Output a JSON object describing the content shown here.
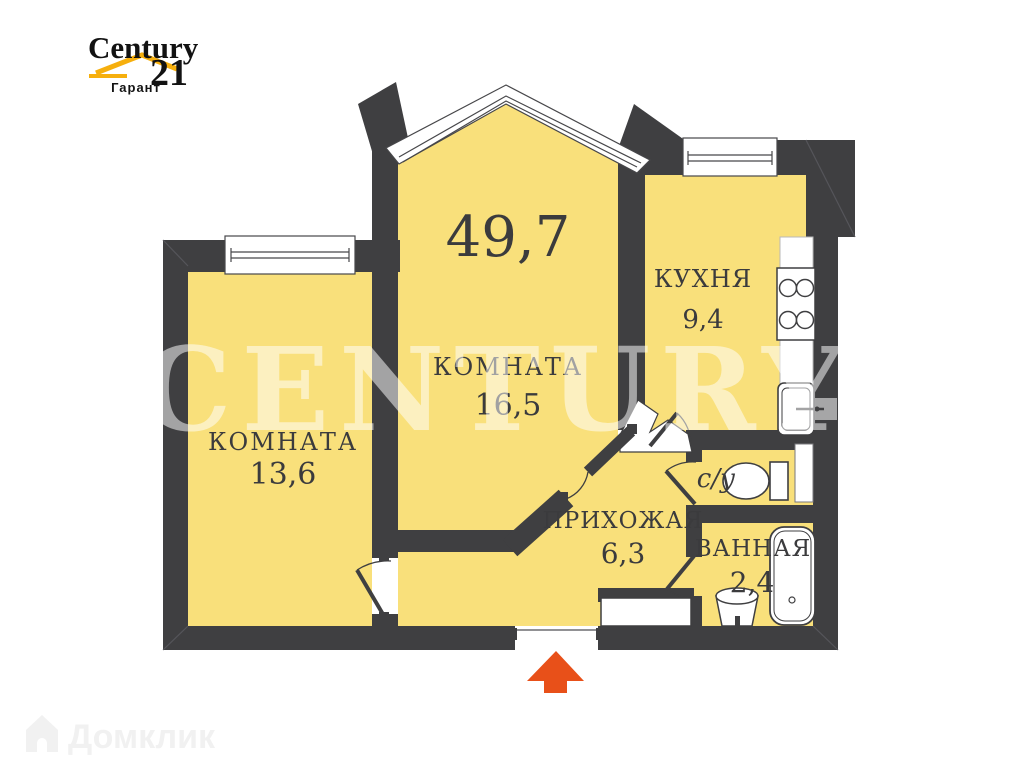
{
  "branding": {
    "agency_logo": {
      "name": "Century",
      "number": "21",
      "subtitle": "Гарант"
    },
    "watermark_text": "CENTURY 21",
    "portal_watermark": "Домклик"
  },
  "plan": {
    "total_area": "49,7",
    "rooms": [
      {
        "id": "room-left",
        "label": "КОМНАТА",
        "area": "13,6"
      },
      {
        "id": "room-middle",
        "label": "КОМНАТА",
        "area": "16,5"
      },
      {
        "id": "kitchen",
        "label": "КУХНЯ",
        "area": "9,4"
      },
      {
        "id": "wc",
        "label": "с/у",
        "area": ""
      },
      {
        "id": "hallway",
        "label": "ПРИХОЖАЯ",
        "area": "6,3"
      },
      {
        "id": "bathroom",
        "label": "ВАННАЯ",
        "area": "2,4"
      }
    ],
    "icons": [
      "window",
      "bathtub",
      "toilet",
      "sink",
      "stove",
      "entrance-arrow"
    ],
    "colors": {
      "room_fill": "#F9E07B",
      "wall": "#3F3F41",
      "entrance_arrow": "#E85019",
      "logo_gold": "#F6AF0D",
      "label_text": "#3b3b3d"
    }
  }
}
